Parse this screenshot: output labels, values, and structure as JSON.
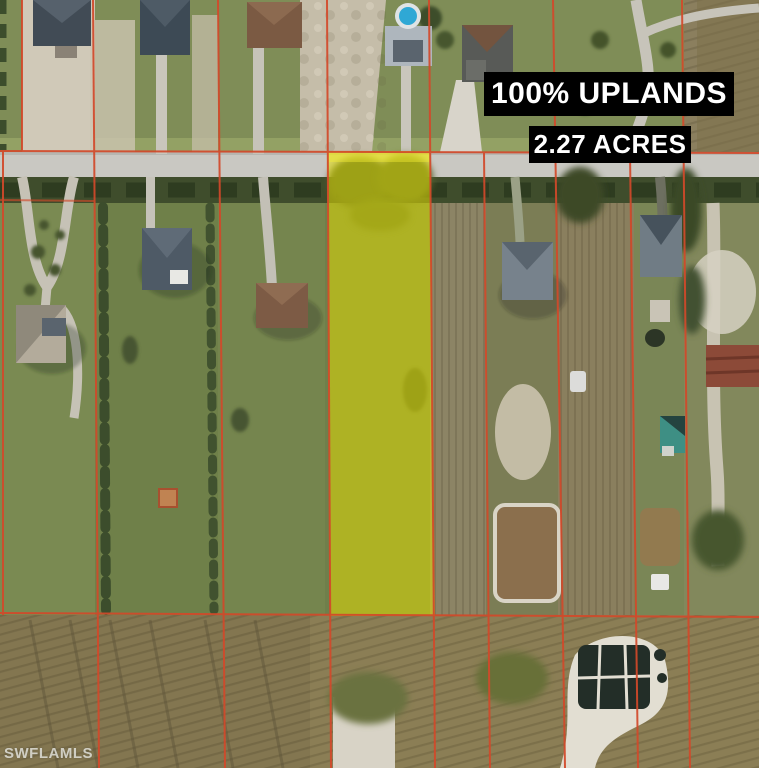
{
  "overlays": {
    "uplands": "100% UPLANDS",
    "acres": "2.27 ACRES"
  },
  "watermark": "SWFLAMLS",
  "colors": {
    "boundary": "#d2492a",
    "highlight": "#e8e000",
    "label_background": "#000000",
    "label_text": "#ffffff",
    "road": "#c9c8c2",
    "watermark_text": "#e8e8e2"
  }
}
